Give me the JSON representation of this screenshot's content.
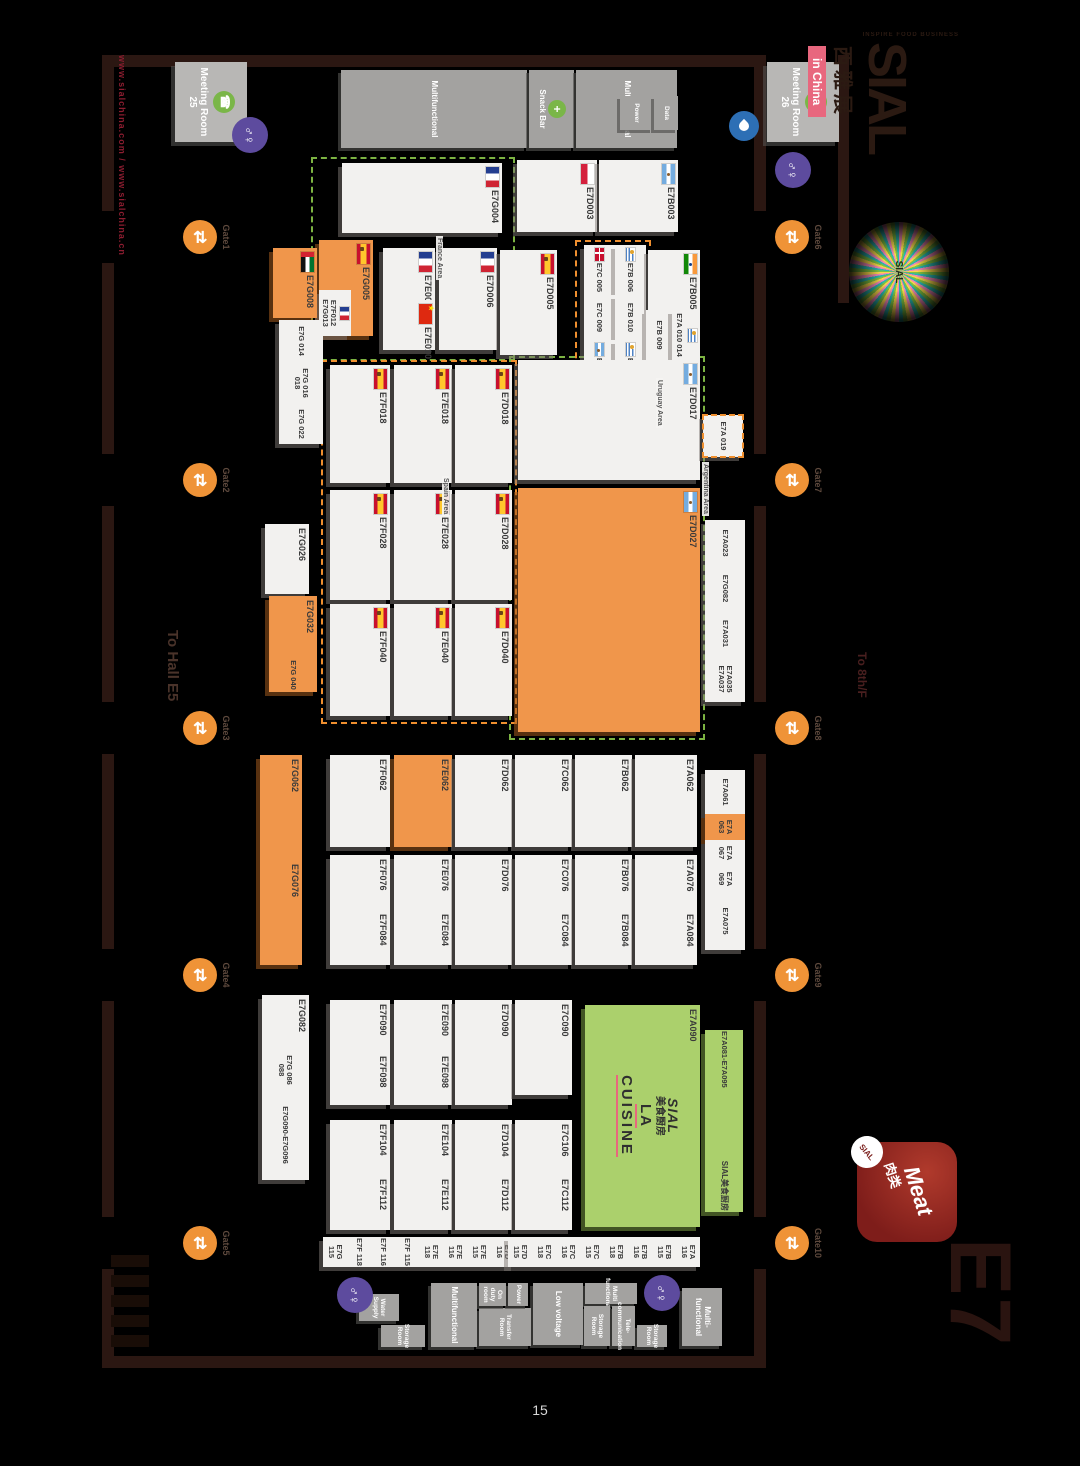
{
  "page": {
    "number": "15"
  },
  "branding": {
    "sial_logo": "SIAL",
    "sial_tagline": "INSPIRE FOOD BUSINESS",
    "sial_cn": "西雅展",
    "in_china": "in China",
    "starburst_text": "SIAL",
    "meat_en": "Meat",
    "meat_cn": "肉类",
    "meat_badge": "SIAL",
    "hall_code": "E7",
    "website": "www.sialchina.com / www.sialchina.cn"
  },
  "icons": {
    "restroom": "♂♀",
    "gate": "⇄",
    "meeting": "☎",
    "snack": "+",
    "accent_orange": "#ef9337",
    "accent_purple": "#5d4b9e",
    "accent_green": "#7ab648"
  },
  "map": {
    "labels": {
      "to_hall": "To Hall E5",
      "to_8f": "To 8th/F"
    },
    "walls": [
      {
        "x": 55,
        "y": 249,
        "w": 12,
        "h": 664
      },
      {
        "x": 1356,
        "y": 249,
        "w": 12,
        "h": 664
      },
      {
        "x": 55,
        "y": 249,
        "w": 156,
        "h": 12
      },
      {
        "x": 263,
        "y": 249,
        "w": 191,
        "h": 12
      },
      {
        "x": 506,
        "y": 249,
        "w": 196,
        "h": 12
      },
      {
        "x": 754,
        "y": 249,
        "w": 195,
        "h": 12
      },
      {
        "x": 1001,
        "y": 249,
        "w": 216,
        "h": 12
      },
      {
        "x": 1269,
        "y": 249,
        "w": 87,
        "h": 12
      },
      {
        "x": 55,
        "y": 901,
        "w": 156,
        "h": 12
      },
      {
        "x": 263,
        "y": 901,
        "w": 191,
        "h": 12
      },
      {
        "x": 506,
        "y": 901,
        "w": 196,
        "h": 12
      },
      {
        "x": 754,
        "y": 901,
        "w": 195,
        "h": 12
      },
      {
        "x": 1001,
        "y": 901,
        "w": 216,
        "h": 12
      },
      {
        "x": 1269,
        "y": 901,
        "w": 99,
        "h": 12
      },
      {
        "x": 55,
        "y": 166,
        "w": 248,
        "h": 11
      }
    ],
    "areas": [
      {
        "name": "France Area",
        "x": 157,
        "y": 500,
        "w": 200,
        "h": 200,
        "c": "green",
        "lx": 236,
        "ly": 572
      },
      {
        "name": "Spain Area",
        "x": 360,
        "y": 498,
        "w": 360,
        "h": 192,
        "c": "orange",
        "lx": 476,
        "ly": 566
      },
      {
        "name": "Argentina Area",
        "x": 356,
        "y": 310,
        "w": 380,
        "h": 192,
        "c": "green",
        "lx": 462,
        "ly": 306
      },
      {
        "name": "Uruguay Area",
        "x": 240,
        "y": 364,
        "w": 155,
        "h": 72,
        "c": "orange",
        "lx": 378,
        "ly": 352
      }
    ],
    "booths": [
      {
        "id": "E7G004",
        "x": 163,
        "y": 513,
        "w": 70,
        "h": 160,
        "flag": "france"
      },
      {
        "id": "E7D003",
        "x": 160,
        "y": 418,
        "w": 72,
        "h": 80,
        "flag": "poland"
      },
      {
        "id": "E7B003",
        "x": 160,
        "y": 337,
        "w": 72,
        "h": 79,
        "flag": "argentina"
      },
      {
        "id": "E7G005",
        "x": 240,
        "y": 642,
        "w": 96,
        "h": 54,
        "color": "orange",
        "flag": "spain"
      },
      {
        "id": "E7F012 E7G013",
        "x": 290,
        "y": 664,
        "w": 46,
        "h": 32,
        "flag": "france",
        "small": true
      },
      {
        "id": "E7G008",
        "x": 248,
        "y": 698,
        "w": 70,
        "h": 44,
        "color": "orange",
        "flag": "uae"
      },
      {
        "id": "E7G 014",
        "x": 320,
        "y": 692,
        "w": 42,
        "h": 44,
        "small": true
      },
      {
        "id": "E7G 016 018",
        "x": 362,
        "y": 692,
        "w": 42,
        "h": 44,
        "small": true
      },
      {
        "id": "E7G 022",
        "x": 404,
        "y": 692,
        "w": 40,
        "h": 44,
        "small": true
      },
      {
        "id": "E7E006",
        "x": 248,
        "y": 580,
        "w": 52,
        "h": 52,
        "flag": "france"
      },
      {
        "id": "E7E010",
        "x": 300,
        "y": 580,
        "w": 50,
        "h": 52,
        "flag": "china"
      },
      {
        "id": "E7D006",
        "x": 248,
        "y": 518,
        "w": 102,
        "h": 58,
        "flag": "france"
      },
      {
        "id": "E7D005",
        "x": 250,
        "y": 458,
        "w": 105,
        "h": 57,
        "flag": "spain"
      },
      {
        "id": "E7C 005",
        "x": 245,
        "y": 400,
        "w": 50,
        "h": 31,
        "flag": "denmark",
        "small": true
      },
      {
        "id": "E7B 006",
        "x": 245,
        "y": 369,
        "w": 50,
        "h": 31,
        "flag": "uruguay",
        "small": true
      },
      {
        "id": "E7C 009",
        "x": 295,
        "y": 400,
        "w": 45,
        "h": 31,
        "small": true
      },
      {
        "id": "E7B 010",
        "x": 295,
        "y": 369,
        "w": 45,
        "h": 31,
        "small": true
      },
      {
        "id": "E7C 013",
        "x": 340,
        "y": 400,
        "w": 50,
        "h": 31,
        "flag": "argentina",
        "small": true
      },
      {
        "id": "E7B 014",
        "x": 340,
        "y": 369,
        "w": 50,
        "h": 31,
        "flag": "uruguay",
        "small": true
      },
      {
        "id": "E7B005",
        "x": 250,
        "y": 315,
        "w": 60,
        "h": 52,
        "flag": "india"
      },
      {
        "id": "E7B 009",
        "x": 310,
        "y": 343,
        "w": 50,
        "h": 26,
        "small": true
      },
      {
        "id": "E7A 010 014",
        "x": 310,
        "y": 315,
        "w": 50,
        "h": 28,
        "flag": "uruguay",
        "small": true
      },
      {
        "id": "E7D017",
        "x": 360,
        "y": 315,
        "w": 120,
        "h": 182,
        "flag": "argentina"
      },
      {
        "id": "E7A 019",
        "x": 415,
        "y": 272,
        "w": 42,
        "h": 40,
        "small": true,
        "dashed": "orange"
      },
      {
        "id": "E7F018",
        "x": 365,
        "y": 625,
        "w": 118,
        "h": 60,
        "flag": "spain"
      },
      {
        "id": "E7E018",
        "x": 365,
        "y": 563,
        "w": 118,
        "h": 58,
        "flag": "spain"
      },
      {
        "id": "E7D018",
        "x": 365,
        "y": 503,
        "w": 118,
        "h": 57,
        "flag": "spain"
      },
      {
        "id": "E7F028",
        "x": 490,
        "y": 625,
        "w": 110,
        "h": 60,
        "flag": "spain"
      },
      {
        "id": "E7E028",
        "x": 490,
        "y": 563,
        "w": 110,
        "h": 58,
        "flag": "spain"
      },
      {
        "id": "E7D028",
        "x": 490,
        "y": 503,
        "w": 110,
        "h": 57,
        "flag": "spain"
      },
      {
        "id": "E7D027",
        "x": 488,
        "y": 315,
        "w": 244,
        "h": 182,
        "color": "orange",
        "flag": "argentina"
      },
      {
        "id": "E7G026",
        "x": 524,
        "y": 706,
        "w": 70,
        "h": 44
      },
      {
        "id": "E7G032",
        "x": 596,
        "y": 698,
        "w": 62,
        "h": 48,
        "color": "orange"
      },
      {
        "id": "E7G 040",
        "x": 658,
        "y": 698,
        "w": 34,
        "h": 48,
        "color": "orange",
        "small": true
      },
      {
        "id": "E7F040",
        "x": 604,
        "y": 625,
        "w": 112,
        "h": 60,
        "flag": "spain"
      },
      {
        "id": "E7E040",
        "x": 604,
        "y": 563,
        "w": 112,
        "h": 58,
        "flag": "spain"
      },
      {
        "id": "E7D040",
        "x": 604,
        "y": 503,
        "w": 112,
        "h": 57,
        "flag": "spain"
      },
      {
        "id": "E7A023",
        "x": 520,
        "y": 270,
        "w": 46,
        "h": 40,
        "small": true
      },
      {
        "id": "E7G082",
        "x": 566,
        "y": 270,
        "w": 45,
        "h": 40,
        "small": true
      },
      {
        "id": "E7A031",
        "x": 611,
        "y": 270,
        "w": 45,
        "h": 40,
        "small": true
      },
      {
        "id": "E7A035 E7A037",
        "x": 656,
        "y": 270,
        "w": 46,
        "h": 40,
        "small": true
      },
      {
        "id": "E7G062",
        "x": 755,
        "y": 713,
        "w": 105,
        "h": 42,
        "color": "orange"
      },
      {
        "id": "E7G076",
        "x": 860,
        "y": 713,
        "w": 105,
        "h": 42,
        "color": "orange"
      },
      {
        "id": "E7F062",
        "x": 755,
        "y": 625,
        "w": 92,
        "h": 60
      },
      {
        "id": "E7E062",
        "x": 755,
        "y": 563,
        "w": 92,
        "h": 58,
        "color": "orange"
      },
      {
        "id": "E7D062",
        "x": 755,
        "y": 503,
        "w": 92,
        "h": 57
      },
      {
        "id": "E7C062",
        "x": 755,
        "y": 443,
        "w": 92,
        "h": 57
      },
      {
        "id": "E7B062",
        "x": 755,
        "y": 383,
        "w": 92,
        "h": 57
      },
      {
        "id": "E7A062",
        "x": 755,
        "y": 318,
        "w": 92,
        "h": 62
      },
      {
        "id": "E7A061",
        "x": 770,
        "y": 270,
        "w": 44,
        "h": 40,
        "small": true
      },
      {
        "id": "E7A 063",
        "x": 814,
        "y": 270,
        "w": 26,
        "h": 40,
        "small": true,
        "color": "orange"
      },
      {
        "id": "E7A 067",
        "x": 840,
        "y": 270,
        "w": 26,
        "h": 40,
        "small": true
      },
      {
        "id": "E7A 069",
        "x": 866,
        "y": 270,
        "w": 26,
        "h": 40,
        "small": true
      },
      {
        "id": "E7A075",
        "x": 892,
        "y": 270,
        "w": 58,
        "h": 40,
        "small": true
      },
      {
        "id": "E7F076",
        "x": 855,
        "y": 625,
        "w": 55,
        "h": 60
      },
      {
        "id": "E7F084",
        "x": 910,
        "y": 625,
        "w": 55,
        "h": 60
      },
      {
        "id": "E7E076",
        "x": 855,
        "y": 563,
        "w": 55,
        "h": 58
      },
      {
        "id": "E7E084",
        "x": 910,
        "y": 563,
        "w": 55,
        "h": 58
      },
      {
        "id": "E7D076",
        "x": 855,
        "y": 503,
        "w": 110,
        "h": 57
      },
      {
        "id": "E7C076",
        "x": 855,
        "y": 443,
        "w": 55,
        "h": 57
      },
      {
        "id": "E7C084",
        "x": 910,
        "y": 443,
        "w": 55,
        "h": 57
      },
      {
        "id": "E7B076",
        "x": 855,
        "y": 383,
        "w": 55,
        "h": 57
      },
      {
        "id": "E7B084",
        "x": 910,
        "y": 383,
        "w": 55,
        "h": 57
      },
      {
        "id": "E7A076",
        "x": 855,
        "y": 318,
        "w": 55,
        "h": 62
      },
      {
        "id": "E7A084",
        "x": 910,
        "y": 318,
        "w": 55,
        "h": 62
      },
      {
        "id": "E7G082",
        "x": 995,
        "y": 706,
        "w": 55,
        "h": 47
      },
      {
        "id": "E7G 086 088",
        "x": 1050,
        "y": 706,
        "w": 40,
        "h": 47,
        "small": true
      },
      {
        "id": "E7G090-E7G096",
        "x": 1090,
        "y": 706,
        "w": 90,
        "h": 47,
        "small": true
      },
      {
        "id": "E7F090",
        "x": 1000,
        "y": 625,
        "w": 52,
        "h": 60
      },
      {
        "id": "E7F098",
        "x": 1052,
        "y": 625,
        "w": 53,
        "h": 60
      },
      {
        "id": "E7E090",
        "x": 1000,
        "y": 563,
        "w": 52,
        "h": 58
      },
      {
        "id": "E7E098",
        "x": 1052,
        "y": 563,
        "w": 53,
        "h": 58
      },
      {
        "id": "E7D090",
        "x": 1000,
        "y": 503,
        "w": 105,
        "h": 57
      },
      {
        "id": "E7C090",
        "x": 1000,
        "y": 443,
        "w": 95,
        "h": 57
      },
      {
        "id": "E7A090",
        "x": 1005,
        "y": 315,
        "w": 222,
        "h": 115,
        "color": "green",
        "center": [
          "SIAL",
          "美食厨房",
          "LA",
          "CUISINE"
        ]
      },
      {
        "id": "E7A081-E7A095",
        "x": 1030,
        "y": 272,
        "w": 182,
        "h": 38,
        "color": "green",
        "small": true,
        "sub": "SIAL美食厨房"
      },
      {
        "id": "E7F104",
        "x": 1120,
        "y": 625,
        "w": 55,
        "h": 60
      },
      {
        "id": "E7F112",
        "x": 1175,
        "y": 625,
        "w": 55,
        "h": 60
      },
      {
        "id": "E7E104",
        "x": 1120,
        "y": 563,
        "w": 55,
        "h": 58
      },
      {
        "id": "E7E112",
        "x": 1175,
        "y": 563,
        "w": 55,
        "h": 58
      },
      {
        "id": "E7D104",
        "x": 1120,
        "y": 503,
        "w": 55,
        "h": 57
      },
      {
        "id": "E7D112",
        "x": 1175,
        "y": 503,
        "w": 55,
        "h": 57
      },
      {
        "id": "E7C106",
        "x": 1120,
        "y": 443,
        "w": 55,
        "h": 57
      },
      {
        "id": "E7C112",
        "x": 1175,
        "y": 443,
        "w": 55,
        "h": 57
      },
      {
        "id": "E7D 116",
        "x": 1237,
        "y": 500,
        "w": 30,
        "h": 24,
        "small": true
      },
      {
        "id": "E7E 115",
        "x": 1237,
        "y": 524,
        "w": 30,
        "h": 24,
        "small": true
      },
      {
        "id": "E7E 116",
        "x": 1237,
        "y": 548,
        "w": 30,
        "h": 24,
        "small": true
      },
      {
        "id": "E7E 118",
        "x": 1237,
        "y": 572,
        "w": 30,
        "h": 24,
        "small": true
      },
      {
        "id": "E7F 115",
        "x": 1237,
        "y": 596,
        "w": 30,
        "h": 24,
        "small": true
      },
      {
        "id": "E7F 116",
        "x": 1237,
        "y": 620,
        "w": 30,
        "h": 24,
        "small": true
      },
      {
        "id": "E7F 118",
        "x": 1237,
        "y": 644,
        "w": 30,
        "h": 24,
        "small": true
      },
      {
        "id": "E7G 115",
        "x": 1237,
        "y": 668,
        "w": 30,
        "h": 24,
        "small": true
      },
      {
        "id": "E7A 116",
        "x": 1237,
        "y": 315,
        "w": 30,
        "h": 24,
        "small": true
      },
      {
        "id": "E7B 115",
        "x": 1237,
        "y": 339,
        "w": 30,
        "h": 24,
        "small": true
      },
      {
        "id": "E7B 116",
        "x": 1237,
        "y": 363,
        "w": 30,
        "h": 24,
        "small": true
      },
      {
        "id": "E7B 118",
        "x": 1237,
        "y": 387,
        "w": 30,
        "h": 24,
        "small": true
      },
      {
        "id": "E7C 115",
        "x": 1237,
        "y": 411,
        "w": 30,
        "h": 24,
        "small": true
      },
      {
        "id": "E7C 116",
        "x": 1237,
        "y": 435,
        "w": 30,
        "h": 24,
        "small": true
      },
      {
        "id": "E7C 118",
        "x": 1237,
        "y": 459,
        "w": 30,
        "h": 24,
        "small": true
      },
      {
        "id": "E7D 115",
        "x": 1237,
        "y": 483,
        "w": 30,
        "h": 24,
        "small": true
      }
    ],
    "facilities": [
      {
        "label": "Multifunctional",
        "x": 70,
        "y": 488,
        "w": 78,
        "h": 186
      },
      {
        "label": "Snack Bar",
        "x": 70,
        "y": 441,
        "w": 78,
        "h": 45,
        "icon": "snack"
      },
      {
        "label": "Multifunctional",
        "x": 70,
        "y": 338,
        "w": 78,
        "h": 101
      },
      {
        "label": "Power",
        "x": 96,
        "y": 362,
        "w": 34,
        "h": 33,
        "small": true
      },
      {
        "label": "Data",
        "x": 96,
        "y": 337,
        "w": 34,
        "h": 24,
        "small": true
      },
      {
        "label": "Multi- functional",
        "x": 1288,
        "y": 293,
        "w": 58,
        "h": 40
      },
      {
        "label": "Storage Room",
        "x": 1325,
        "y": 348,
        "w": 22,
        "h": 30,
        "small": true
      },
      {
        "label": "Multi functional",
        "x": 1283,
        "y": 378,
        "w": 21,
        "h": 52,
        "small": true
      },
      {
        "label": "Tele- communication",
        "x": 1306,
        "y": 380,
        "w": 40,
        "h": 23,
        "small": true
      },
      {
        "label": "Storage Room",
        "x": 1306,
        "y": 405,
        "w": 40,
        "h": 26,
        "small": true
      },
      {
        "label": "Low voltage",
        "x": 1283,
        "y": 432,
        "w": 62,
        "h": 50
      },
      {
        "label": "Transfer Room",
        "x": 1308,
        "y": 484,
        "w": 38,
        "h": 52,
        "small": true
      },
      {
        "label": "Power",
        "x": 1283,
        "y": 487,
        "w": 23,
        "h": 20,
        "small": true
      },
      {
        "label": "On duty room",
        "x": 1283,
        "y": 509,
        "w": 23,
        "h": 27,
        "small": true
      },
      {
        "label": "Multifunctional",
        "x": 1283,
        "y": 538,
        "w": 64,
        "h": 46
      },
      {
        "label": "Storage Room",
        "x": 1325,
        "y": 590,
        "w": 22,
        "h": 44,
        "small": true
      },
      {
        "label": "Water Supply",
        "x": 1294,
        "y": 616,
        "w": 27,
        "h": 40,
        "small": true
      }
    ],
    "meeting_rooms": [
      {
        "label": "Meeting Room 26",
        "x": 62,
        "y": 176,
        "w": 80,
        "h": 72
      },
      {
        "label": "Meeting Room 25",
        "x": 62,
        "y": 768,
        "w": 80,
        "h": 72
      }
    ],
    "gates": [
      {
        "label": "Gate1",
        "x": 237,
        "side": "bottom"
      },
      {
        "label": "Gate2",
        "x": 480,
        "side": "bottom"
      },
      {
        "label": "Gate3",
        "x": 728,
        "side": "bottom"
      },
      {
        "label": "Gate4",
        "x": 975,
        "side": "bottom"
      },
      {
        "label": "Gate5",
        "x": 1243,
        "side": "bottom"
      },
      {
        "label": "Gate6",
        "x": 237,
        "side": "top"
      },
      {
        "label": "Gate7",
        "x": 480,
        "side": "top"
      },
      {
        "label": "Gate8",
        "x": 728,
        "side": "top"
      },
      {
        "label": "Gate9",
        "x": 975,
        "side": "top"
      },
      {
        "label": "Gate10",
        "x": 1243,
        "side": "top"
      }
    ],
    "restrooms": [
      {
        "x": 117,
        "y": 747
      },
      {
        "x": 152,
        "y": 204
      },
      {
        "x": 1275,
        "y": 335
      },
      {
        "x": 1277,
        "y": 642
      }
    ],
    "water_points": [
      {
        "x": 111,
        "y": 256
      }
    ],
    "stairs": {
      "x": 1255,
      "y": 866,
      "bars": 5
    }
  }
}
